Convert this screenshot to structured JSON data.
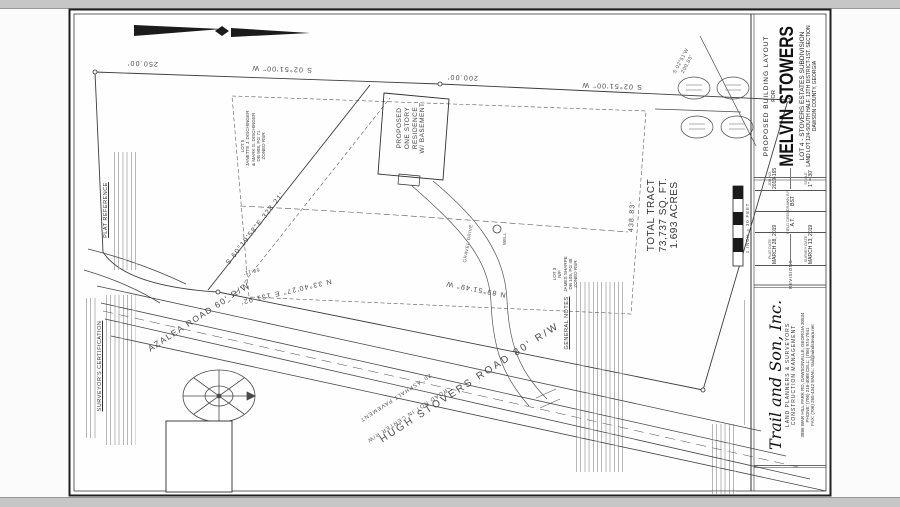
{
  "sheet": {
    "title_block": {
      "kicker": "PROPOSED BUILDING LAYOUT",
      "for_label": "FOR",
      "client": "MELVIN STOWERS",
      "line1": "LOT 4 - STOVERS ESTATES SUBDIVISION",
      "line2": "LAND LOT 124-SOUTH HALF, 13TH DISTRICT-1ST. SECTION",
      "line3": "DAWSON COUNTY, GEORGIA"
    },
    "info_table": {
      "revisions_label": "REVISIONS",
      "rows": [
        {
          "label": "PLAT DATE",
          "value": "MARCH 28, 2019"
        },
        {
          "label": "SURVEY DATE",
          "value": "MARCH 13, 2019"
        },
        {
          "label": "FIELD CREW",
          "value": "A.T."
        },
        {
          "label": "DRAWN BY",
          "value": "BST"
        },
        {
          "label": "JOB NO.",
          "value": "2019-165"
        },
        {
          "label": "SCALE",
          "value": "1\" = 30'"
        }
      ]
    },
    "firm": {
      "name": "Trail and Son, Inc.",
      "tagline1": "LAND PLANNERS & SURVEYORS",
      "tagline2": "CONSTRUCTION MANAGEMENT",
      "address": "3886 WAR HILL PARK RD, DAWSONVILLE, GEORGIA 30534",
      "phones": "PHONE: (706) 216-4088    CELL: (706) 974-7941",
      "fax_email": "FAX: (706) 265-4342    EMAIL: trail@windstream.net"
    },
    "scale_bar_caption": "1 INCH = 30 FEET"
  },
  "survey": {
    "dimensions": {
      "top_left_len": "250.00'",
      "top_left_brg": "S 02°51'00\" W",
      "top_right_len": "200.00'",
      "top_right_brg": "S 02°51'00\" W",
      "corner_brg_1": "S 02°51'W",
      "corner_brg_2": "200.83'",
      "left_diag": "S 60°19'58\"E  328.21'",
      "right_len": "438.83'",
      "bottom_brg": "N 89°51'49\" W",
      "azalea_brg": "N 33°40'27\" E  131.92'",
      "azalea_len": "69.11'"
    },
    "labels": {
      "residence": [
        "PROPOSED",
        "ONE STORY",
        "RESIDENCE",
        "W/ BASEMENT"
      ],
      "total_tract": [
        "TOTAL TRACT",
        "73,737 SQ. FT.",
        "1.693 ACRES"
      ],
      "road_main": "HUGH STOVERS ROAD 80' R/W",
      "road_pavement": "20' ASPHALT PAVEMENT",
      "road_note": "ROAD NOT IN CENTER R/W",
      "road_azalea": "AZALEA ROAD 60' R/W",
      "well": "WELL",
      "drive": "GRAVEL DRIVE"
    },
    "adjoiners": {
      "lot3": [
        "LOT 3",
        "N/F",
        "JAMES SHARPE",
        "DB 105, PG 48",
        "PB 66, PG 109",
        "ZONED RSR"
      ],
      "lot5": [
        "LOT 5",
        "N/F",
        "JANETTE J. DISCHINGER",
        "& MARK S. DISCHINGER",
        "DB 908, PG 71",
        "ZONED RSR"
      ]
    },
    "notes": {
      "surveyor_cert_title": "SURVEYOR'S CERTIFICATION",
      "plat_reference_title": "PLAT REFERENCE",
      "general_notes_title": "GENERAL NOTES"
    }
  }
}
